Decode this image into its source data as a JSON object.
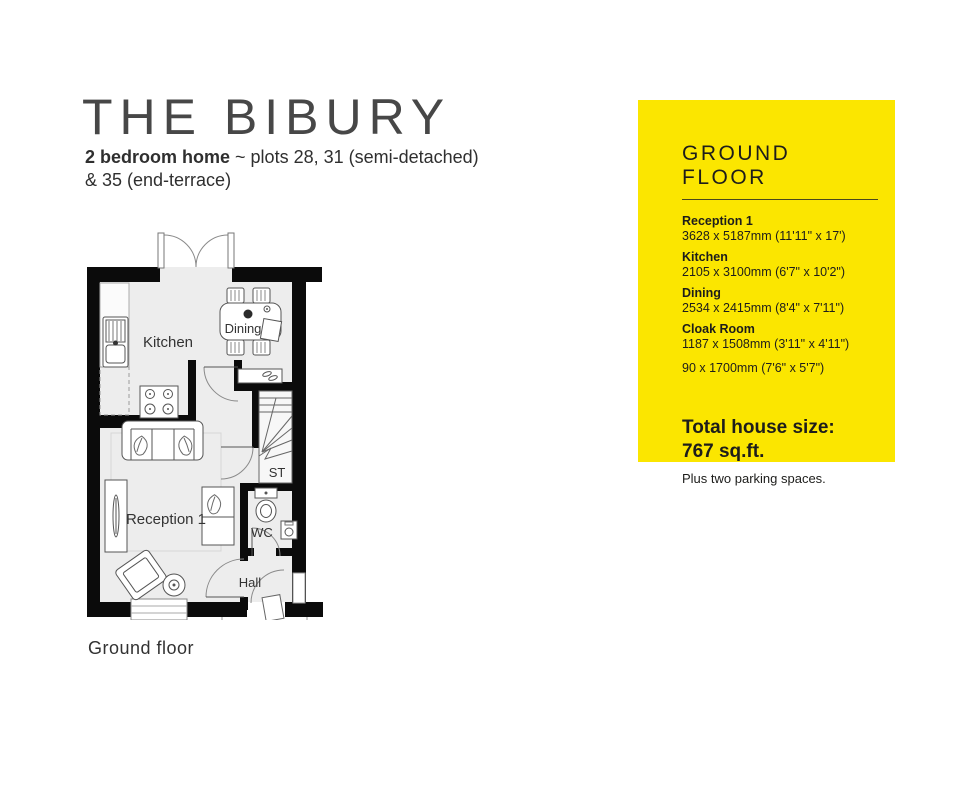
{
  "header": {
    "title": "THE BIBURY",
    "subtitle_bold": "2 bedroom home",
    "subtitle_rest": " ~ plots 28, 31 (semi-detached)",
    "subtitle_line2": "& 35 (end-terrace)"
  },
  "floorplan": {
    "caption": "Ground floor",
    "rooms": {
      "kitchen": "Kitchen",
      "dining": "Dining",
      "reception": "Reception 1",
      "storage": "ST",
      "wc": "WC",
      "hall": "Hall"
    }
  },
  "panel": {
    "heading": "GROUND FLOOR",
    "accent_color": "#FBE600",
    "text_color": "#1d1d1b",
    "items": [
      {
        "name": "Reception 1",
        "dims": "3628 x 5187mm (11'11\" x 17')"
      },
      {
        "name": "Kitchen",
        "dims": "2105 x 3100mm (6'7\" x 10'2\")"
      },
      {
        "name": "Dining",
        "dims": "2534 x 2415mm (8'4\" x 7'11\")"
      },
      {
        "name": "Cloak Room",
        "dims": "1187 x 1508mm (3'11\" x 4'11\")"
      },
      {
        "dims": "90 x 1700mm (7'6\" x 5'7\")"
      }
    ],
    "total_label": "Total house size:",
    "total_value": "767 sq.ft.",
    "note": "Plus two parking spaces."
  }
}
